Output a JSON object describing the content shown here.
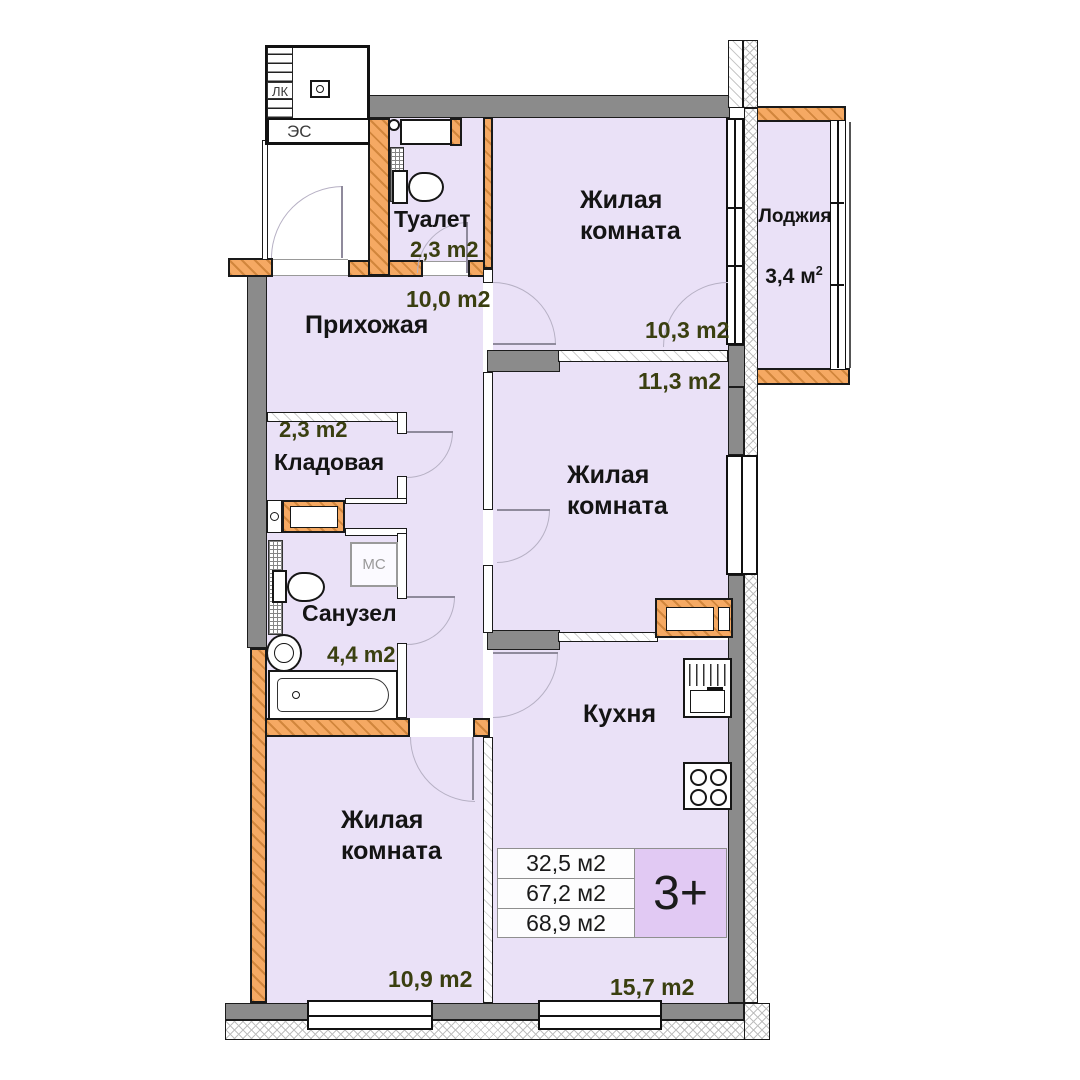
{
  "colors": {
    "room_fill": "#EAE1F7",
    "wall_gray": "#8B8B8B",
    "wall_orange": "#F5A963",
    "badge_bg": "#E1C9F3",
    "area_text_color": "#3A3F10"
  },
  "rooms": {
    "toilet": {
      "name": "Туалет",
      "area": "2,3 m2"
    },
    "hallway": {
      "name": "Прихожая",
      "area": "10,0 m2"
    },
    "living_top": {
      "name": "Жилая комната",
      "area": "10,3 m2"
    },
    "loggia": {
      "name": "Лоджия",
      "area_base": "3,4 м",
      "area_sup": "2"
    },
    "living_mid": {
      "name": "Жилая комната",
      "area": "11,3 m2"
    },
    "storage": {
      "name": "Кладовая",
      "area": "2,3 m2"
    },
    "bathroom": {
      "name": "Санузел",
      "area": "4,4 m2"
    },
    "kitchen": {
      "name": "Кухня",
      "area": "15,7 m2"
    },
    "living_bottom": {
      "name": "Жилая комната",
      "area": "10,9 m2"
    }
  },
  "summary": {
    "rows": [
      "32,5 м2",
      "67,2 м2",
      "68,9 м2"
    ],
    "badge": "3+"
  },
  "core": {
    "stairs_label": "ЛК",
    "elevator_label": "ЭС"
  },
  "appliances": {
    "washing_machine": "МС"
  }
}
